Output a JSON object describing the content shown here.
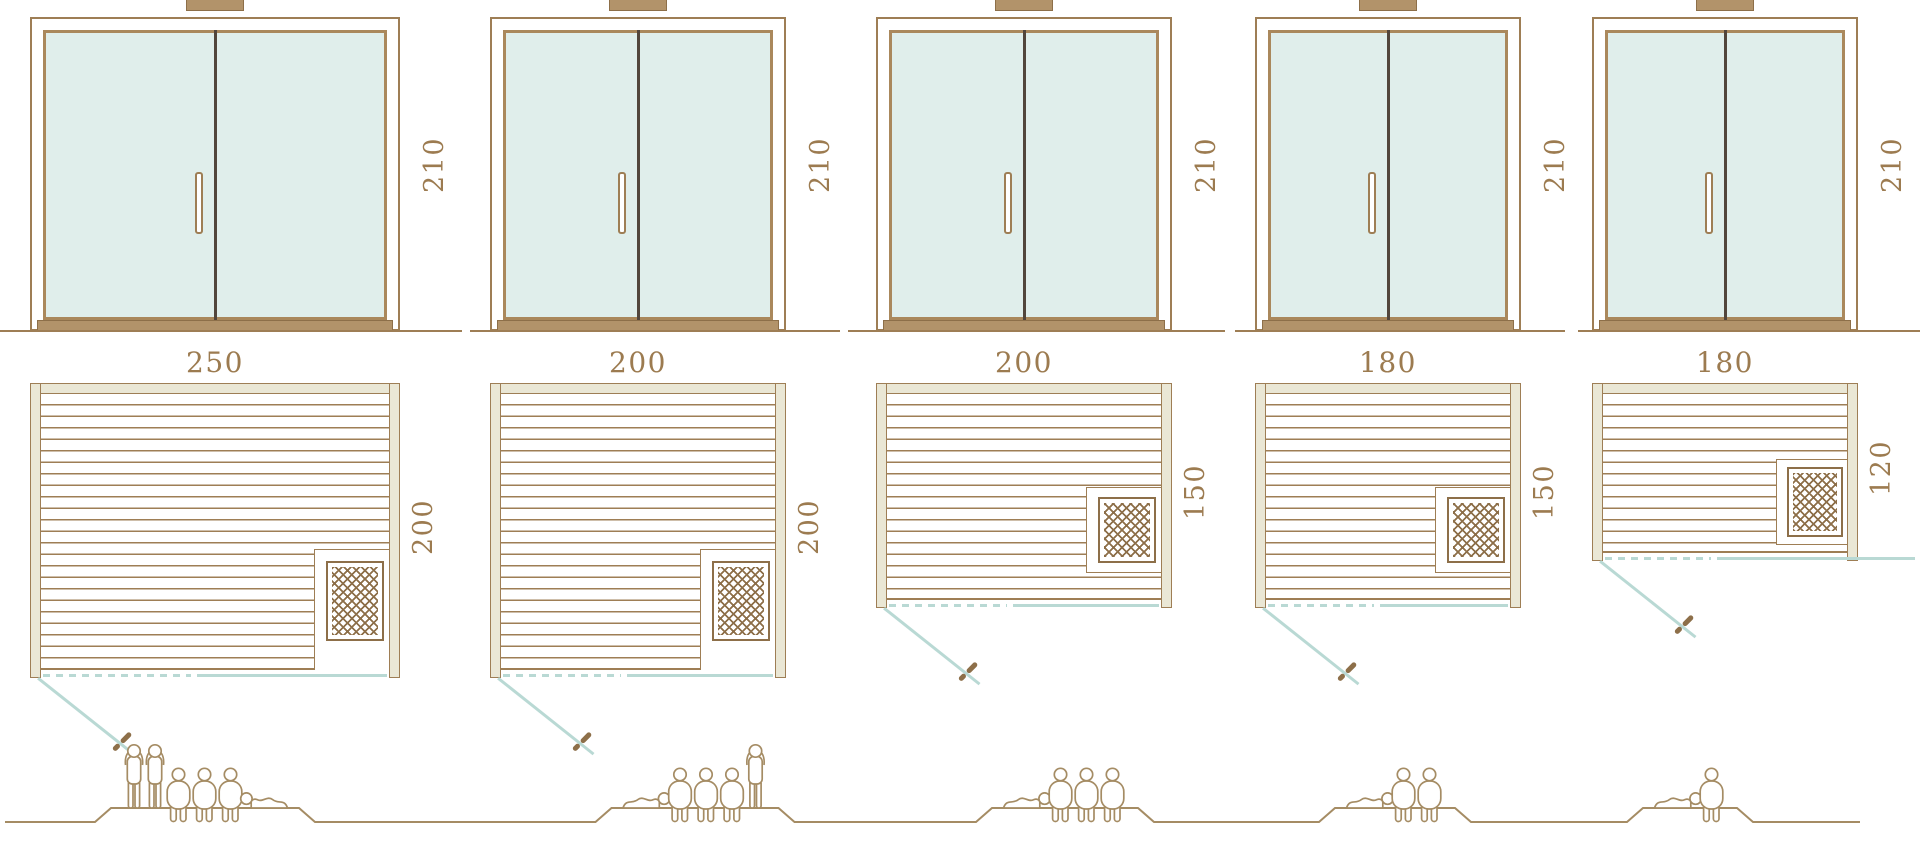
{
  "diagram": {
    "kind": "sauna-size-options",
    "views": [
      "front-elevation",
      "floor-plan",
      "capacity"
    ]
  },
  "units": [
    {
      "id": "size-250x200",
      "elevation": {
        "height_label": "210"
      },
      "plan": {
        "width_label": "250",
        "depth_label": "200"
      },
      "capacity": {
        "people_count": 6,
        "figures": [
          "standing",
          "standing",
          "seated",
          "seated",
          "seated",
          "lying"
        ]
      }
    },
    {
      "id": "size-200x200",
      "elevation": {
        "height_label": "210"
      },
      "plan": {
        "width_label": "200",
        "depth_label": "200"
      },
      "capacity": {
        "people_count": 5,
        "figures": [
          "lying",
          "seated",
          "seated",
          "seated",
          "standing"
        ]
      }
    },
    {
      "id": "size-200x150",
      "elevation": {
        "height_label": "210"
      },
      "plan": {
        "width_label": "200",
        "depth_label": "150"
      },
      "capacity": {
        "people_count": 4,
        "figures": [
          "lying",
          "seated",
          "seated",
          "seated"
        ]
      }
    },
    {
      "id": "size-180x150",
      "elevation": {
        "height_label": "210"
      },
      "plan": {
        "width_label": "180",
        "depth_label": "150"
      },
      "capacity": {
        "people_count": 3,
        "figures": [
          "lying",
          "seated",
          "seated"
        ]
      }
    },
    {
      "id": "size-180x120",
      "elevation": {
        "height_label": "210"
      },
      "plan": {
        "width_label": "180",
        "depth_label": "120"
      },
      "capacity": {
        "people_count": 2,
        "figures": [
          "lying",
          "seated"
        ]
      }
    }
  ],
  "colors": {
    "outline_brown": "#9e7e55",
    "dark_brown": "#8d6f49",
    "glass_frame": "#aa885c",
    "wall_fill": "#eae7d5",
    "glass_fill": "#e0eeeb",
    "teal_line": "#b9d9d4",
    "label_text": "#9c7b50",
    "door_divider": "#52463c",
    "sill_fill": "#b2936a",
    "people_outline": "#a58c64"
  }
}
